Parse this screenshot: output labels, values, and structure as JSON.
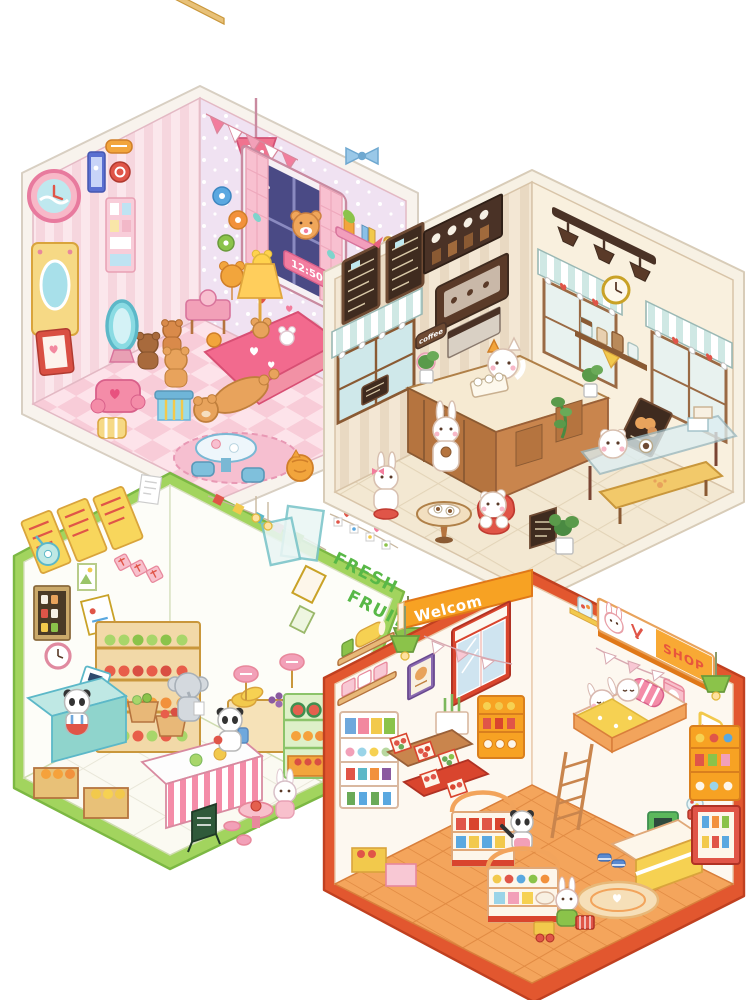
{
  "artwork": {
    "kind": "isometric kawaii room diorama collage",
    "background": "#ffffff",
    "panels": [
      "bedroom",
      "coffee-shop",
      "fresh-fruit-shop",
      "convenience-store"
    ]
  },
  "bedroom": {
    "digital_clock": "12:50",
    "palette": {
      "border": "#f8f3ed",
      "wall_left": "#fbe7ec",
      "wall_right": "#f0e2f2",
      "floor_a": "#f8ccd8",
      "floor_b": "#fde3ea",
      "accent": "#e06a96",
      "blanket": "#f26a8e",
      "teddy": "#e8a35c",
      "night_window": "#4a4a85"
    }
  },
  "coffee_shop": {
    "door_sign": "coffee",
    "palette": {
      "border": "#f7f1e4",
      "wall_left": "#f3e7d4",
      "wall_right": "#f9f0de",
      "floor": "#f3e8d2",
      "wood": "#b5743f",
      "chalkboard": "#3f2b1f",
      "awning": "#cfe8e4",
      "chair": "#e05548"
    }
  },
  "fruit_shop": {
    "wall_sign_line1": "FRESH",
    "wall_sign_line2": "FRUIT",
    "palette": {
      "border": "#a2d45e",
      "wall": "#fdfdf8",
      "floor": "#fbfaf2",
      "sign_green": "#58b847",
      "counter_teal": "#8fd4cc",
      "menu_yellow": "#f8d65c",
      "apple_red": "#e85d4a",
      "orange": "#f5a23c",
      "grape": "#8a5aa0"
    }
  },
  "convenience_store": {
    "marquee": "Welcom",
    "shop_sign": "SHOP",
    "hot_sign": "HOT",
    "palette": {
      "border": "#e2572f",
      "wall": "#fdf8f0",
      "floor": "#f4a55c",
      "marquee_bg": "#f7a223",
      "window_frame": "#d9452e",
      "register_green": "#5cb85c",
      "lamp_green": "#8bc34a"
    }
  }
}
